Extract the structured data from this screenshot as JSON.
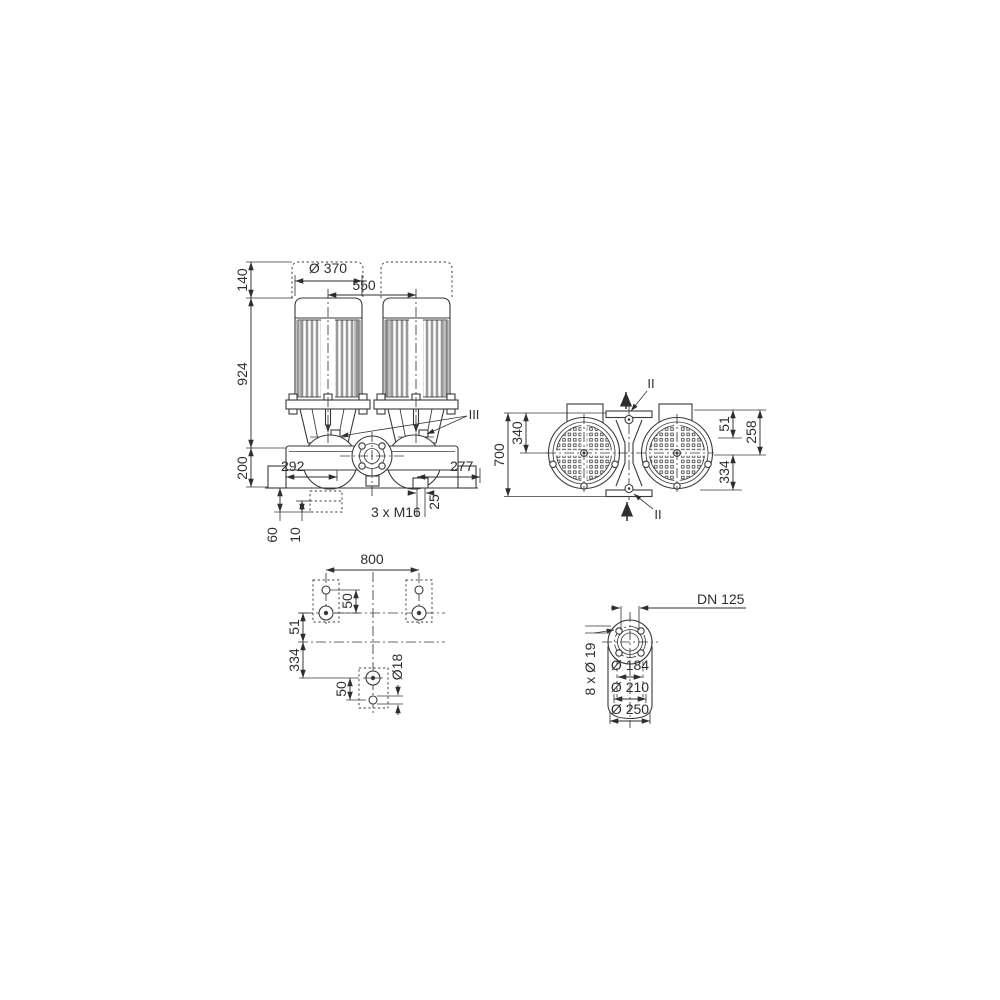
{
  "meta": {
    "background": "#ffffff",
    "line_color": "#3a3a3a",
    "text_color": "#2e2e2e"
  },
  "front_view": {
    "dim_motor_diameter": "Ø 370",
    "dim_motor_spacing": "550",
    "dim_140": "140",
    "dim_924": "924",
    "dim_200": "200",
    "dim_292": "292",
    "dim_277": "277",
    "section_label": "III",
    "thread_label": "3 x M16",
    "dim_25": "25",
    "dim_60": "60",
    "dim_10": "10"
  },
  "top_view": {
    "dim_700": "700",
    "dim_340": "340",
    "dim_51": "51",
    "dim_258": "258",
    "dim_334": "334",
    "section_label": "II"
  },
  "foundation_view": {
    "dim_800": "800",
    "dim_50_upper": "50",
    "dim_51": "51",
    "dim_334": "334",
    "dim_50_lower": "50",
    "anchor_hole_label": "Ø18"
  },
  "flange_view": {
    "nominal_label": "DN 125",
    "dim_raised_face": "Ø 184",
    "dim_bolt_circle": "Ø 210",
    "dim_outer_diameter": "Ø 250",
    "bolt_holes_label": "8 x Ø 19"
  }
}
